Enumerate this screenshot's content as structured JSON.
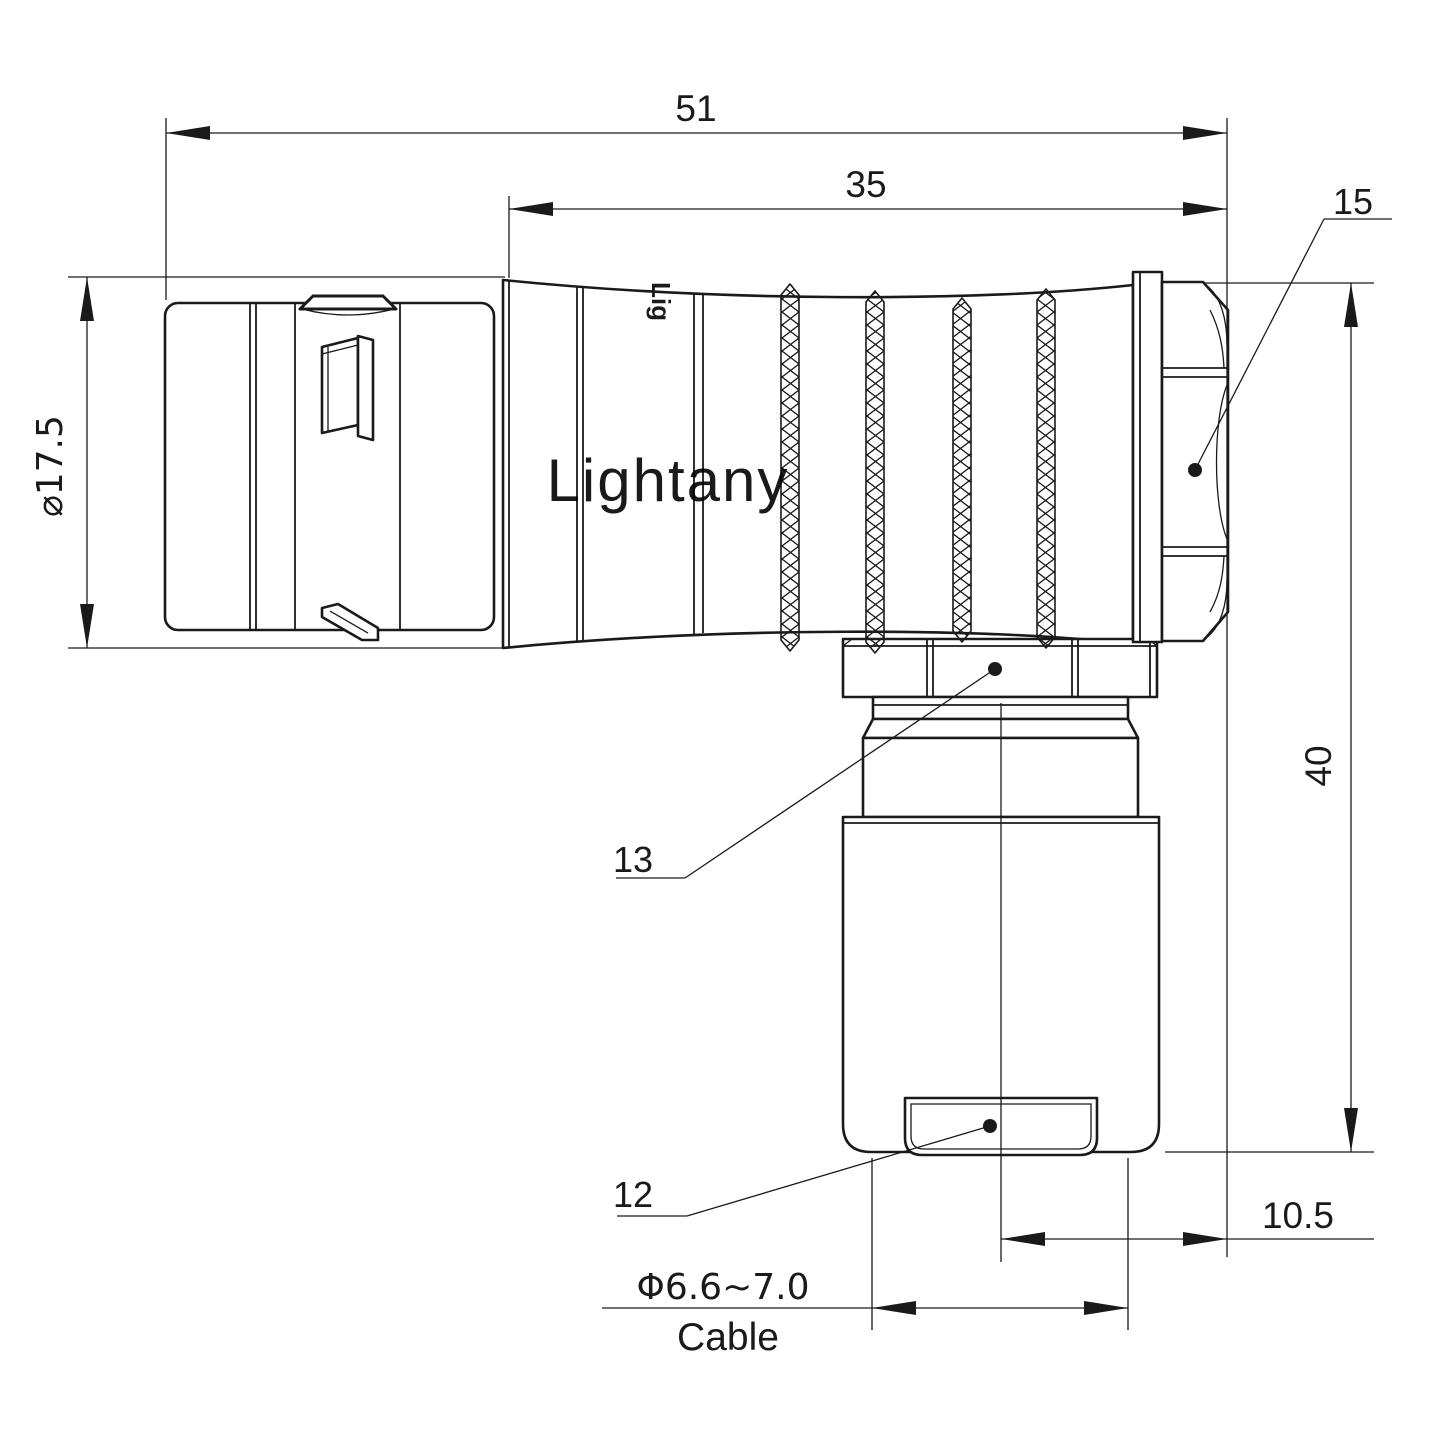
{
  "drawing": {
    "type": "connector-technical-drawing",
    "colors": {
      "line": "#1a1a1a",
      "background": "#ffffff",
      "watermark": "#f5d7d2"
    },
    "watermark": {
      "text": "Lightany"
    },
    "shell_engraving": "Lig",
    "dims": {
      "overall_length": "51",
      "body_length": "35",
      "back_nut_ref": "15",
      "shell_diameter": "⌀17.5",
      "height": "40",
      "coupling_nut_ref": "13",
      "cable_bushing_ref": "12",
      "axis_offset": "10.5",
      "cable_diameter": "Φ6.6~7.0",
      "cable_label": "Cable"
    }
  }
}
